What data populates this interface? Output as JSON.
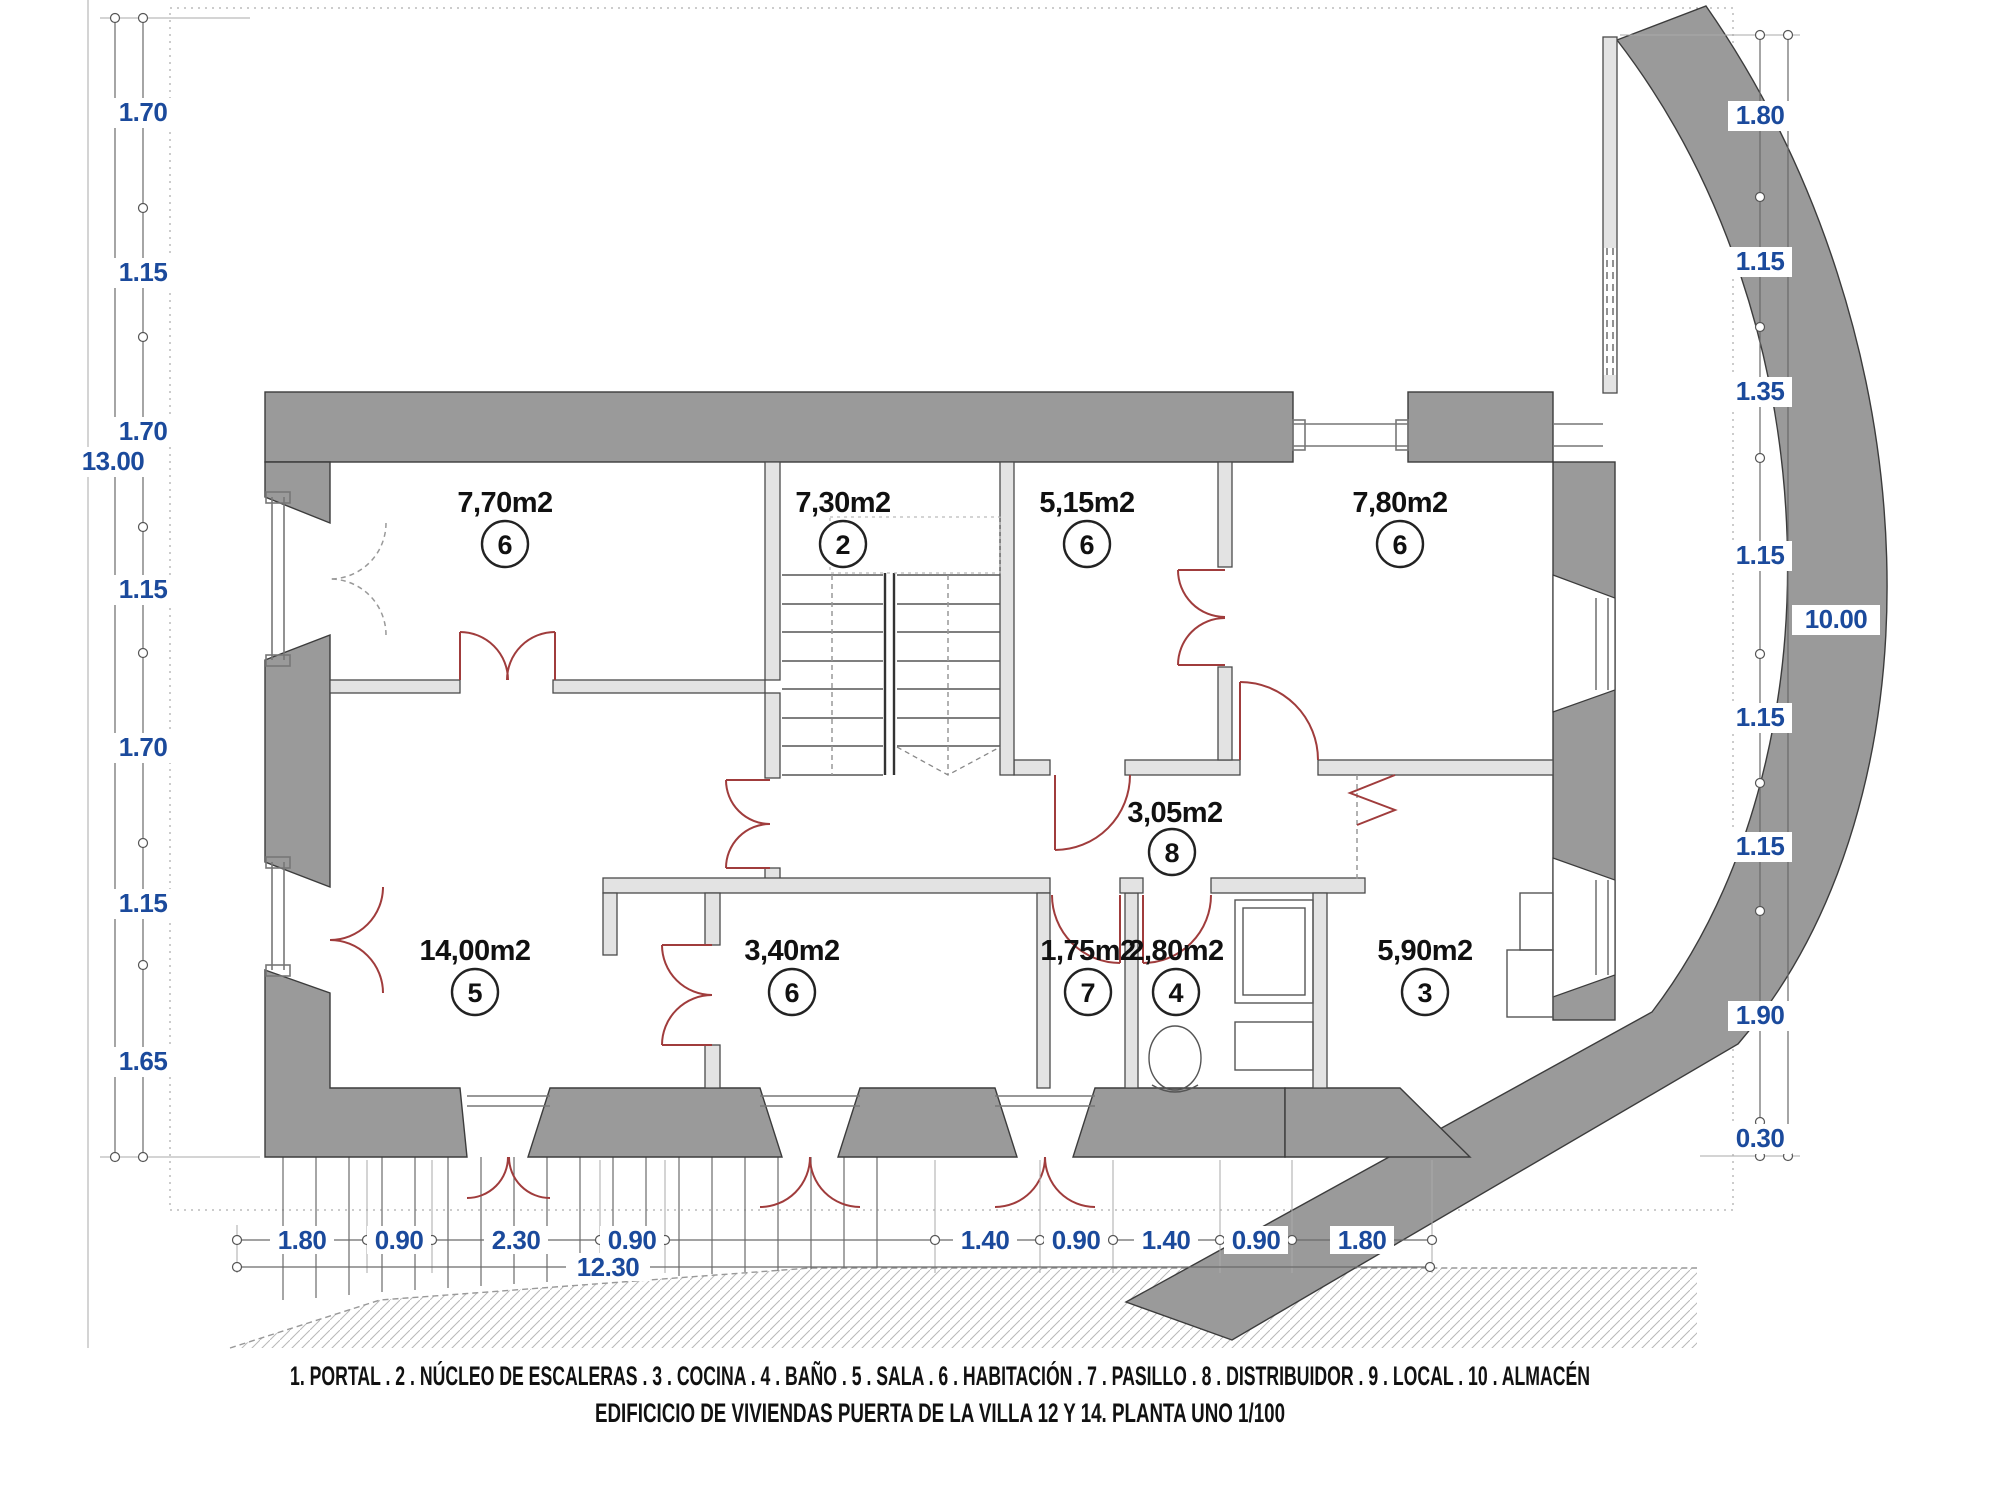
{
  "drawing": {
    "type": "architectural-floor-plan",
    "scale_note": "1/100"
  },
  "rooms": [
    {
      "area": "7,70m2",
      "number": "6"
    },
    {
      "area": "7,30m2",
      "number": "2"
    },
    {
      "area": "5,15m2",
      "number": "6"
    },
    {
      "area": "7,80m2",
      "number": "6"
    },
    {
      "area": "3,05m2",
      "number": "8"
    },
    {
      "area": "14,00m2",
      "number": "5"
    },
    {
      "area": "3,40m2",
      "number": "6"
    },
    {
      "area": "1,75m2",
      "number": "7"
    },
    {
      "area": "2,80m2",
      "number": "4"
    },
    {
      "area": "5,90m2",
      "number": "3"
    }
  ],
  "dims": {
    "left": {
      "segments": [
        "1.70",
        "1.15",
        "1.70",
        "1.15",
        "1.70",
        "1.15",
        "1.65"
      ],
      "total": "13.00"
    },
    "right": {
      "segments": [
        "1.80",
        "1.15",
        "1.35",
        "1.15",
        "1.15",
        "1.15",
        "1.90",
        "0.30"
      ],
      "total": "10.00"
    },
    "bottom": {
      "segments": [
        "1.80",
        "0.90",
        "2.30",
        "0.90",
        "1.40",
        "0.90",
        "1.40",
        "0.90",
        "1.80"
      ],
      "total": "12.30"
    }
  },
  "legend": {
    "line1": "1. PORTAL . 2 . NÚCLEO DE ESCALERAS . 3 . COCINA . 4 . BAÑO . 5 . SALA . 6 . HABITACIÓN . 7 . PASILLO . 8 . DISTRIBUIDOR . 9 . LOCAL . 10 . ALMACÉN",
    "line2": "EDIFICICIO DE VIVIENDAS PUERTA DE LA VILLA 12 Y 14. PLANTA UNO 1/100"
  },
  "colors": {
    "wall": "#9a9a9a",
    "dimension_blue": "#1b4a9c",
    "door_red": "#a03c3c"
  }
}
